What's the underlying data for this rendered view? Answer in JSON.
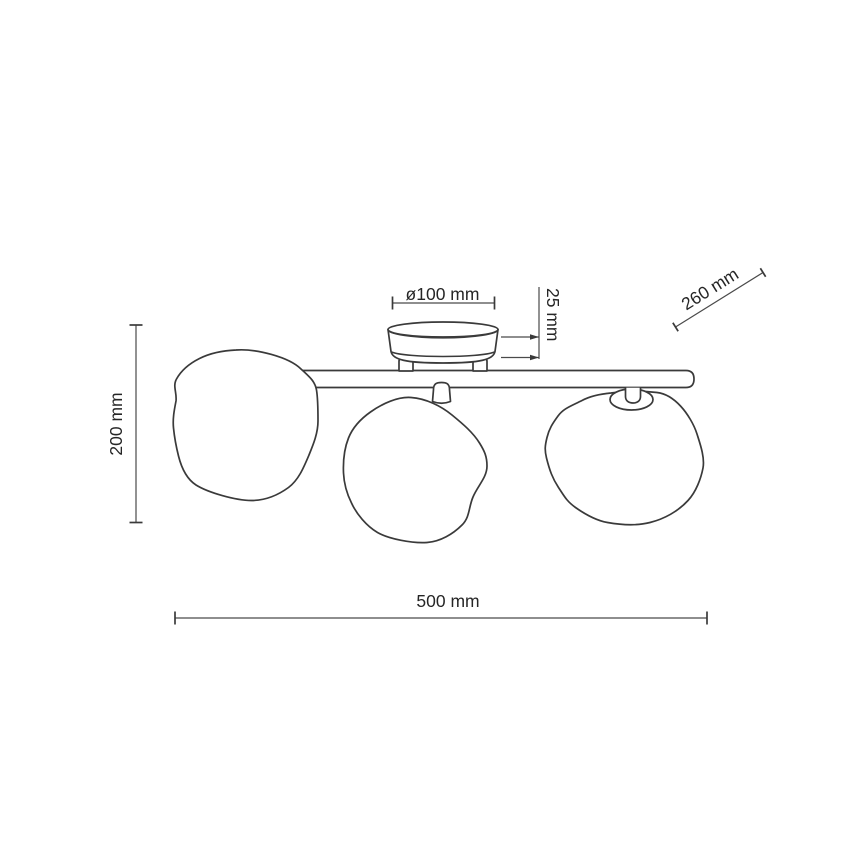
{
  "canvas": {
    "background": "#ffffff",
    "stroke_color": "#3a3a3a",
    "dimension_line_color": "#4a4a4a",
    "text_color": "#262626"
  },
  "drawing": {
    "labels": {
      "canopy_diameter": "ø100 mm",
      "canopy_height": "25 mm",
      "shade_diameter": "260 mm",
      "fixture_height": "200 mm",
      "fixture_width": "500 mm"
    }
  }
}
